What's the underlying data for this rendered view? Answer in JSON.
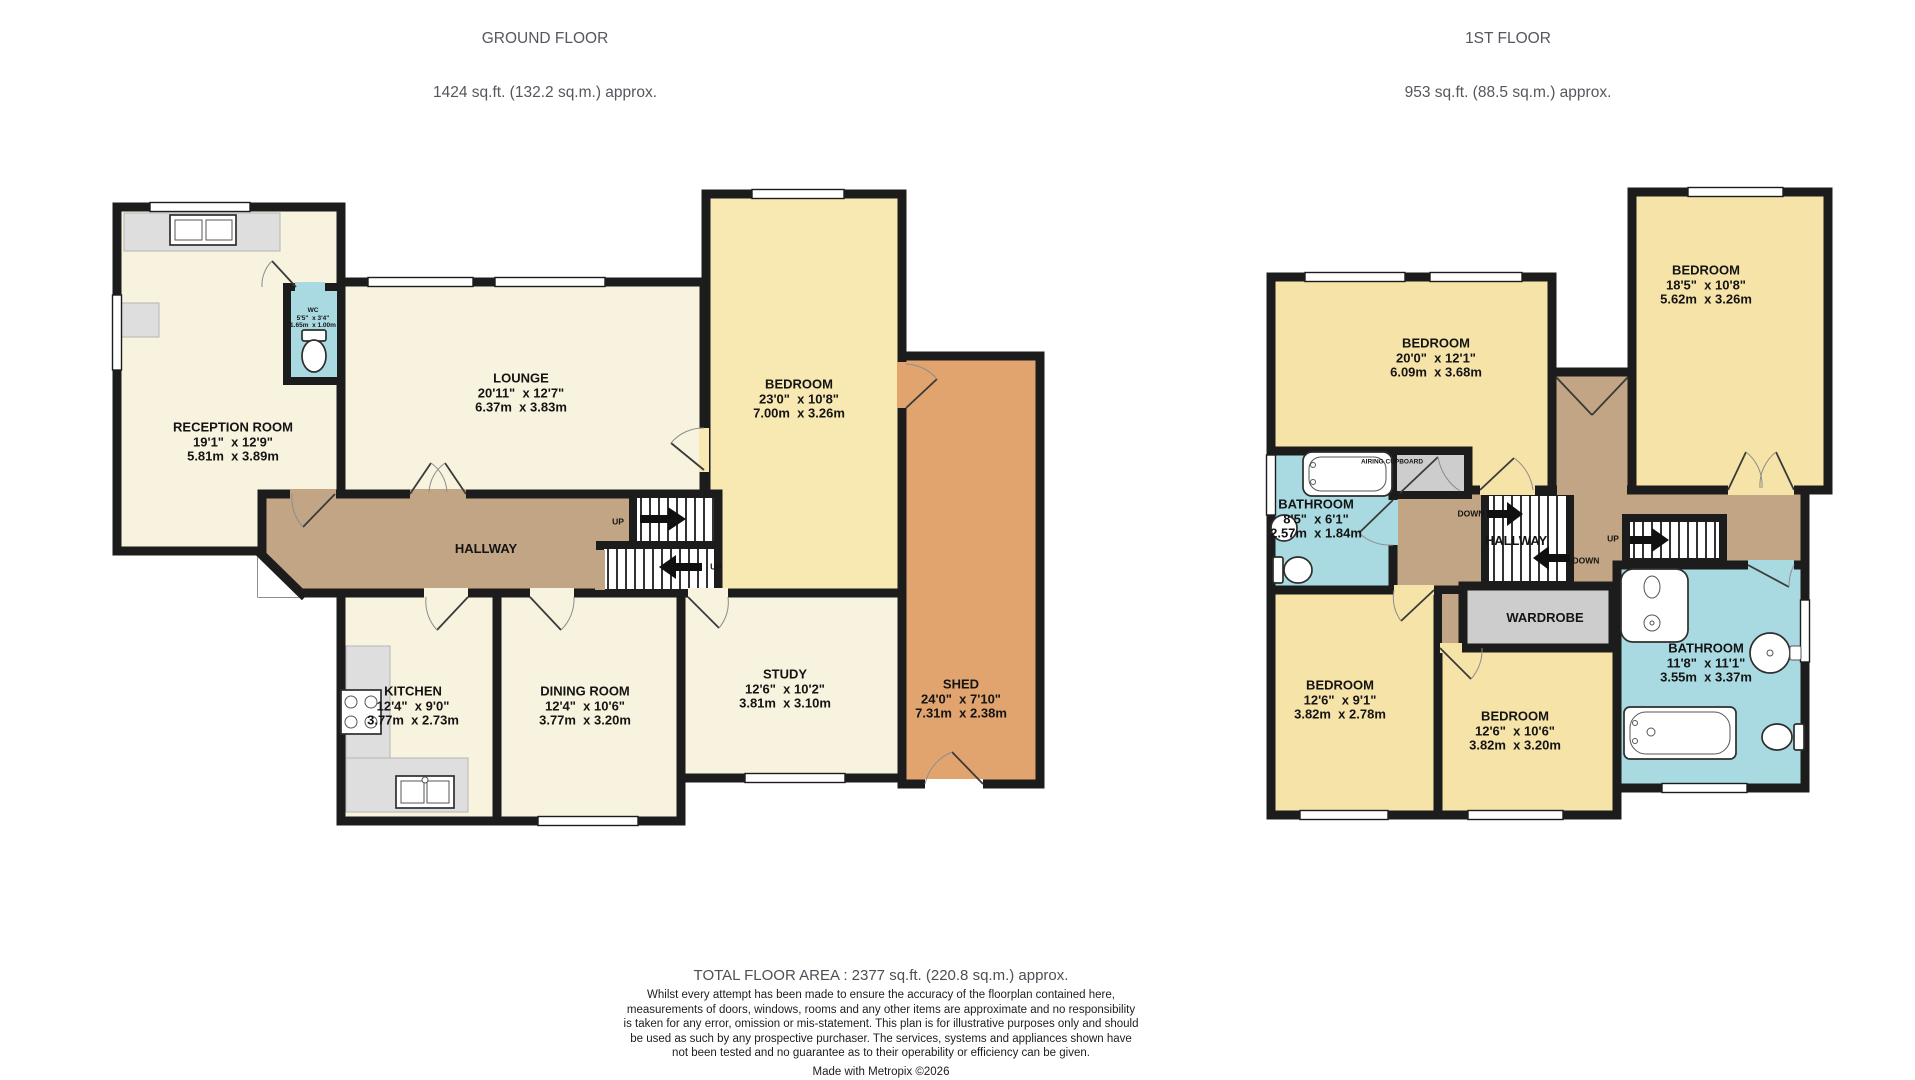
{
  "palette": {
    "wall": "#1c1c1c",
    "cream": "#f7f3de",
    "ybed": "#f8e8b2",
    "ybed2": "#f6e3a8",
    "shed": "#e1a46f",
    "tan": "#c2a584",
    "blue": "#a9dae2",
    "grey": "#cdcdcd",
    "counter": "#dedede",
    "titlegrey": "#56565e"
  },
  "header": {
    "ground_title": "GROUND FLOOR",
    "ground_area": "1424 sq.ft. (132.2 sq.m.) approx.",
    "first_title": "1ST FLOOR",
    "first_area": "953 sq.ft. (88.5 sq.m.) approx."
  },
  "ground_floor": {
    "reception": {
      "name": "RECEPTION ROOM",
      "imperial": "19'1\"  x 12'9\"",
      "metric": "5.81m  x 3.89m"
    },
    "wc": {
      "name": "WC",
      "imperial": "5'5\"  x 3'4\"",
      "metric": "1.65m  x 1.00m"
    },
    "lounge": {
      "name": "LOUNGE",
      "imperial": "20'11\"  x 12'7\"",
      "metric": "6.37m  x 3.83m"
    },
    "bedroom": {
      "name": "BEDROOM",
      "imperial": "23'0\"  x 10'8\"",
      "metric": "7.00m  x 3.26m"
    },
    "hallway": {
      "name": "HALLWAY"
    },
    "kitchen": {
      "name": "KITCHEN",
      "imperial": "12'4\"  x 9'0\"",
      "metric": "3.77m  x 2.73m"
    },
    "dining": {
      "name": "DINING ROOM",
      "imperial": "12'4\"  x 10'6\"",
      "metric": "3.77m  x 3.20m"
    },
    "study": {
      "name": "STUDY",
      "imperial": "12'6\"  x 10'2\"",
      "metric": "3.81m  x 3.10m"
    },
    "shed": {
      "name": "SHED",
      "imperial": "24'0\"  x 7'10\"",
      "metric": "7.31m  x 2.38m"
    },
    "stairs": {
      "up_label": "UP"
    }
  },
  "first_floor": {
    "bedroom1": {
      "name": "BEDROOM",
      "imperial": "20'0\"  x 12'1\"",
      "metric": "6.09m  x 3.68m"
    },
    "bedroom2": {
      "name": "BEDROOM",
      "imperial": "18'5\"  x 10'8\"",
      "metric": "5.62m  x 3.26m"
    },
    "bathroom1": {
      "name": "BATHROOM",
      "imperial": "8'5\"  x 6'1\"",
      "metric": "2.57m  x 1.84m"
    },
    "airing_cupboard": {
      "name": "AIRING CUPBOARD"
    },
    "hallway": {
      "name": "HALLWAY"
    },
    "wardrobe": {
      "name": "WARDROBE"
    },
    "bedroom3": {
      "name": "BEDROOM",
      "imperial": "12'6\"  x 9'1\"",
      "metric": "3.82m  x 2.78m"
    },
    "bedroom4": {
      "name": "BEDROOM",
      "imperial": "12'6\"  x 10'6\"",
      "metric": "3.82m  x 3.20m"
    },
    "bathroom2": {
      "name": "BATHROOM",
      "imperial": "11'8\"  x 11'1\"",
      "metric": "3.55m  x 3.37m"
    },
    "stairs": {
      "up_label": "UP",
      "down_label": "DOWN"
    }
  },
  "footer": {
    "total": "TOTAL FLOOR AREA : 2377 sq.ft. (220.8 sq.m.) approx.",
    "disclaimer": "Whilst every attempt has been made to ensure the accuracy of the floorplan contained here, measurements of doors, windows, rooms and any other items are approximate and no responsibility is taken for any error, omission or mis-statement. This plan is for illustrative purposes only and should be used as such by any prospective purchaser. The services, systems and appliances shown have not been tested and no guarantee as to their operability or efficiency can be given.",
    "credit": "Made with Metropix ©2026"
  }
}
